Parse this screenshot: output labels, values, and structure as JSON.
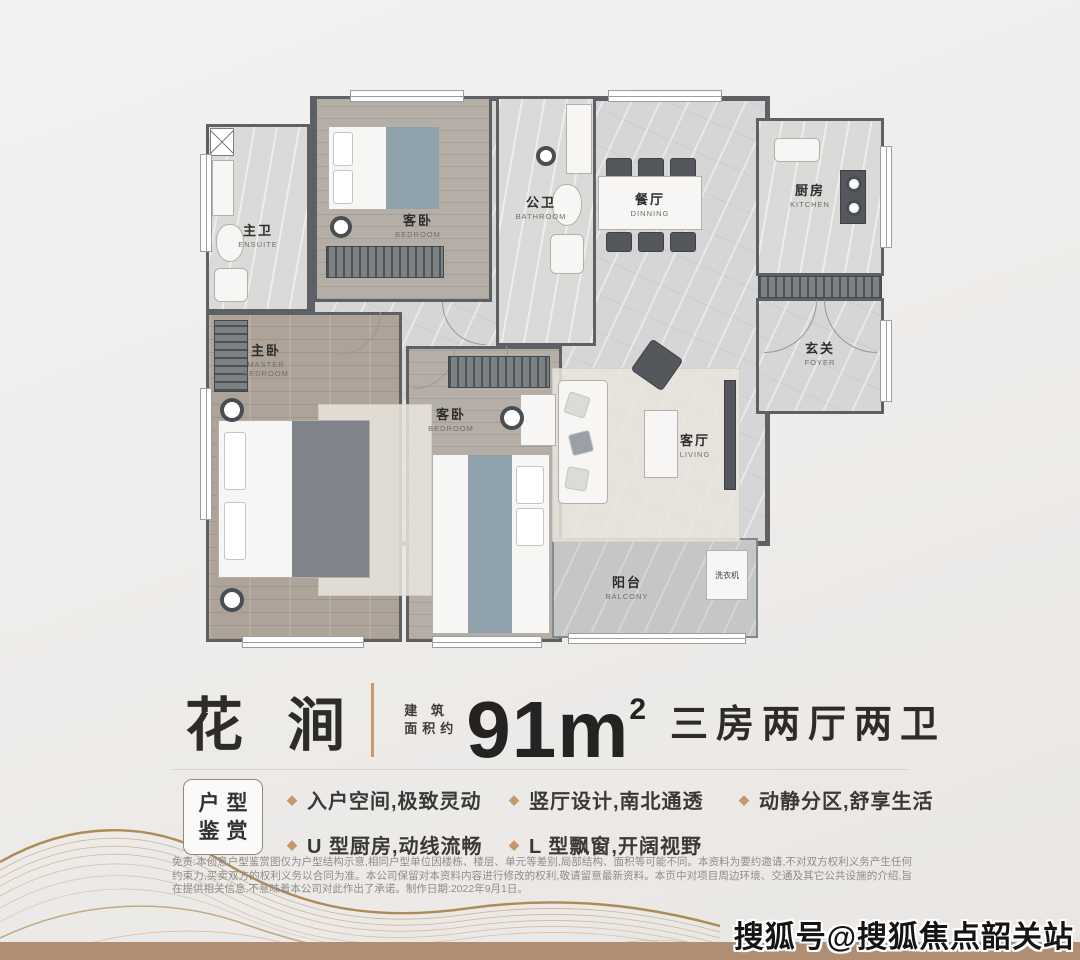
{
  "poster": {
    "name": "花 涧",
    "area_label_l1": "建 筑",
    "area_label_l2": "面积约",
    "area_value": "91m",
    "area_exponent": "2",
    "rooms_summary": "三房两厅两卫"
  },
  "features": {
    "tag_line1": "户型",
    "tag_line2": "鉴赏",
    "bullet_icon": "diamond",
    "items": [
      "入户空间,极致灵动",
      "竖厅设计,南北通透",
      "动静分区,舒享生活",
      "U 型厨房,动线流畅",
      "L 型飘窗,开阔视野"
    ]
  },
  "floorplan": {
    "rooms": [
      {
        "cn": "主卫",
        "en": "ENSUITE"
      },
      {
        "cn": "客卧",
        "en": "BEDROOM"
      },
      {
        "cn": "公卫",
        "en": "BATHROOM"
      },
      {
        "cn": "餐厅",
        "en": "DINNING"
      },
      {
        "cn": "厨房",
        "en": "KITCHEN"
      },
      {
        "cn": "玄关",
        "en": "FOYER"
      },
      {
        "cn": "主卧",
        "en": "MASTER BEDROOM"
      },
      {
        "cn": "客卧",
        "en": "BEDROOM"
      },
      {
        "cn": "客厅",
        "en": "LIVING"
      },
      {
        "cn": "阳台",
        "en": "BALCONY"
      }
    ],
    "washer_label": "洗衣机"
  },
  "disclaimer": {
    "text": "免责:本创意户型鉴赏图仅为户型结构示意,相同户型单位因楼栋、楼层、单元等差别,局部结构、面积等可能不同。本资料为要约邀请,不对双方权利义务产生任何约束力,买卖双方的权利义务以合同为准。本公司保留对本资料内容进行修改的权利,敬请留意最新资料。本页中对项目周边环境、交通及其它公共设施的介绍,旨在提供相关信息,不意味着本公司对此作出了承诺。制作日期:2022年9月1日。"
  },
  "watermark": {
    "text": "搜狐号@搜狐焦点韶关站"
  },
  "colors": {
    "accent": "#c49a6c",
    "wall": "#5d6165",
    "bottom_bar": "#b08e73"
  }
}
